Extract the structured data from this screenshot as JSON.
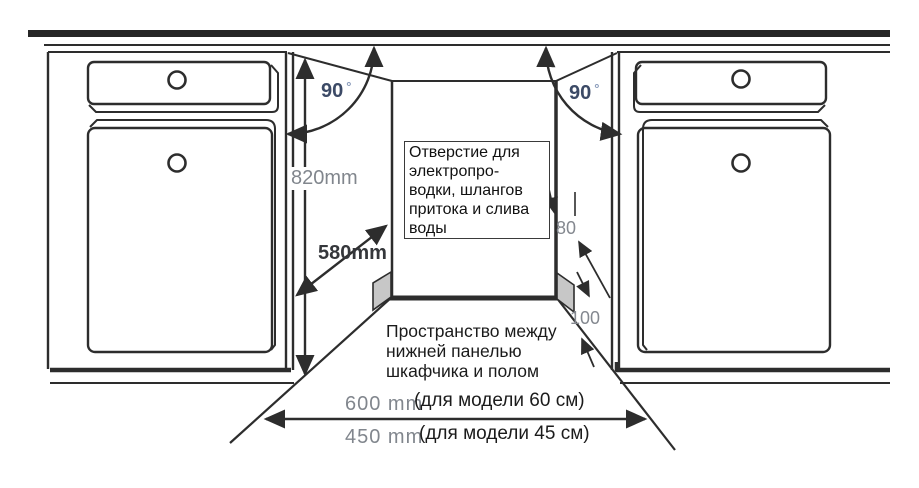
{
  "colors": {
    "line": "#2d2d2d",
    "dim_label_gray": "#81868d",
    "angle_label_blue": "#3c4a66",
    "degree_blue": "#8799b9",
    "depth_label_dark": "#35373b",
    "hole_fill": "#c7c7c7"
  },
  "labels": {
    "angle_left": "90",
    "angle_left_degree": "°",
    "angle_right": "90",
    "angle_right_degree": "°",
    "height": "820mm",
    "depth": "580mm",
    "hole_offset": "80",
    "hole_height": "100",
    "width_600": "600 mm",
    "width_600_note": "(для модели 60 см)",
    "width_450": "450 mm",
    "width_450_note": "(для модели 45 см)"
  },
  "annotations": {
    "opening_note": {
      "line1": "Отверстие для",
      "line2": "электропро-",
      "line3": "водки, шлангов",
      "line4": "притока и слива",
      "line5": "воды"
    },
    "floor_note": {
      "line1": "Пространство между",
      "line2": "нижней панелью",
      "line3": "шкафчика и полом"
    }
  }
}
